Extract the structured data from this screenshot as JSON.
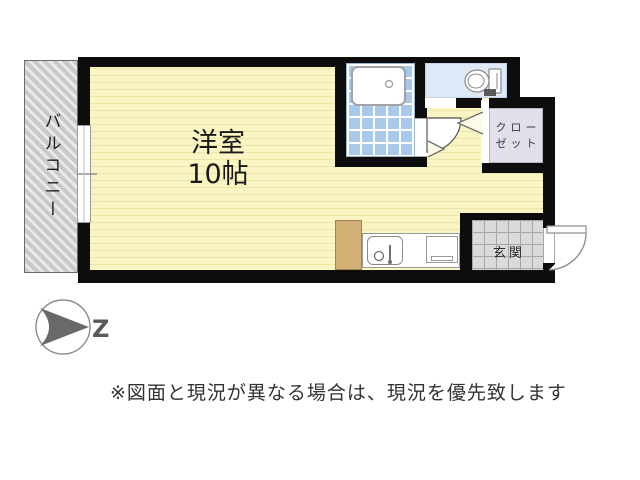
{
  "floorplan": {
    "rooms": {
      "main": {
        "name": "洋室",
        "size": "10帖"
      },
      "balcony": {
        "label": "バルコニー"
      },
      "closet": {
        "label_line1": "クロー",
        "label_line2": "ゼット"
      },
      "entrance": {
        "label": "玄関"
      }
    },
    "fixtures": [
      "bathtub",
      "toilet",
      "kitchen-sink",
      "kitchen-counter",
      "refrigerator-space",
      "window",
      "entry-door",
      "bath-door",
      "bifold-closet-door"
    ],
    "compass": {
      "label": "Z"
    }
  },
  "disclaimer": "※図面と現況が異なる場合は、現況を優先致します",
  "colors": {
    "wall": "#0d0d0d",
    "room-yellow": "#faf5c2",
    "room-yellow-line": "#ece5a7",
    "tile-blue": "#a8c9ec",
    "toilet-blue": "#dde9f6",
    "closet-lav": "#e3dfe9",
    "entry-gray": "#dadada",
    "entry-grid": "#a6a6a6",
    "balcony-gray": "#c9c9c9",
    "fridge-tan": "#d2b076",
    "compass-gray": "#696969"
  }
}
